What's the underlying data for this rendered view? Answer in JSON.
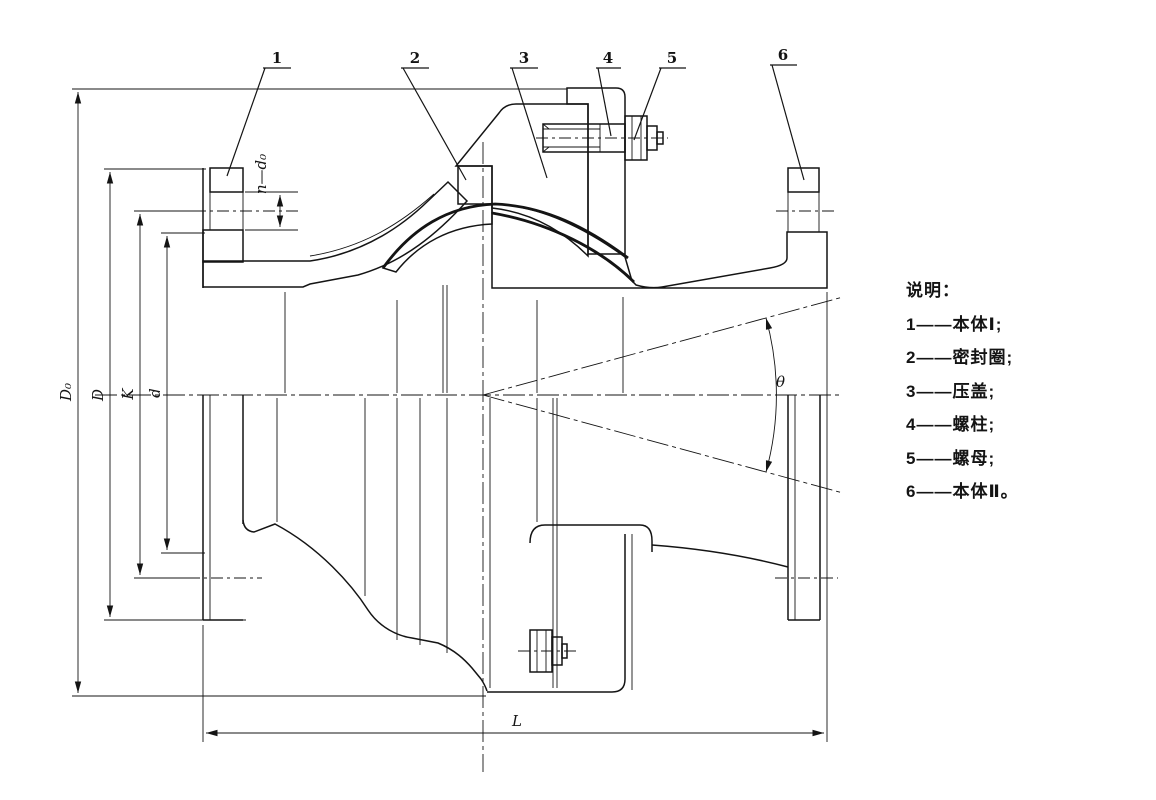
{
  "legend": {
    "title": "说明：",
    "items": [
      {
        "label": "1——本体Ⅰ;"
      },
      {
        "label": "2——密封圈;"
      },
      {
        "label": "3——压盖;"
      },
      {
        "label": "4——螺柱;"
      },
      {
        "label": "5——螺母;"
      },
      {
        "label": "6——本体Ⅱ。"
      }
    ]
  },
  "callouts": {
    "labels": [
      "1",
      "2",
      "3",
      "4",
      "5",
      "6"
    ]
  },
  "dimensions": {
    "outer_diameter": "D₀",
    "flange_diameter": "D",
    "bolt_circle": "K",
    "bore_diameter": "d",
    "bolt_holes": "n—d₀",
    "length": "L",
    "deflection_angle": "θ"
  }
}
